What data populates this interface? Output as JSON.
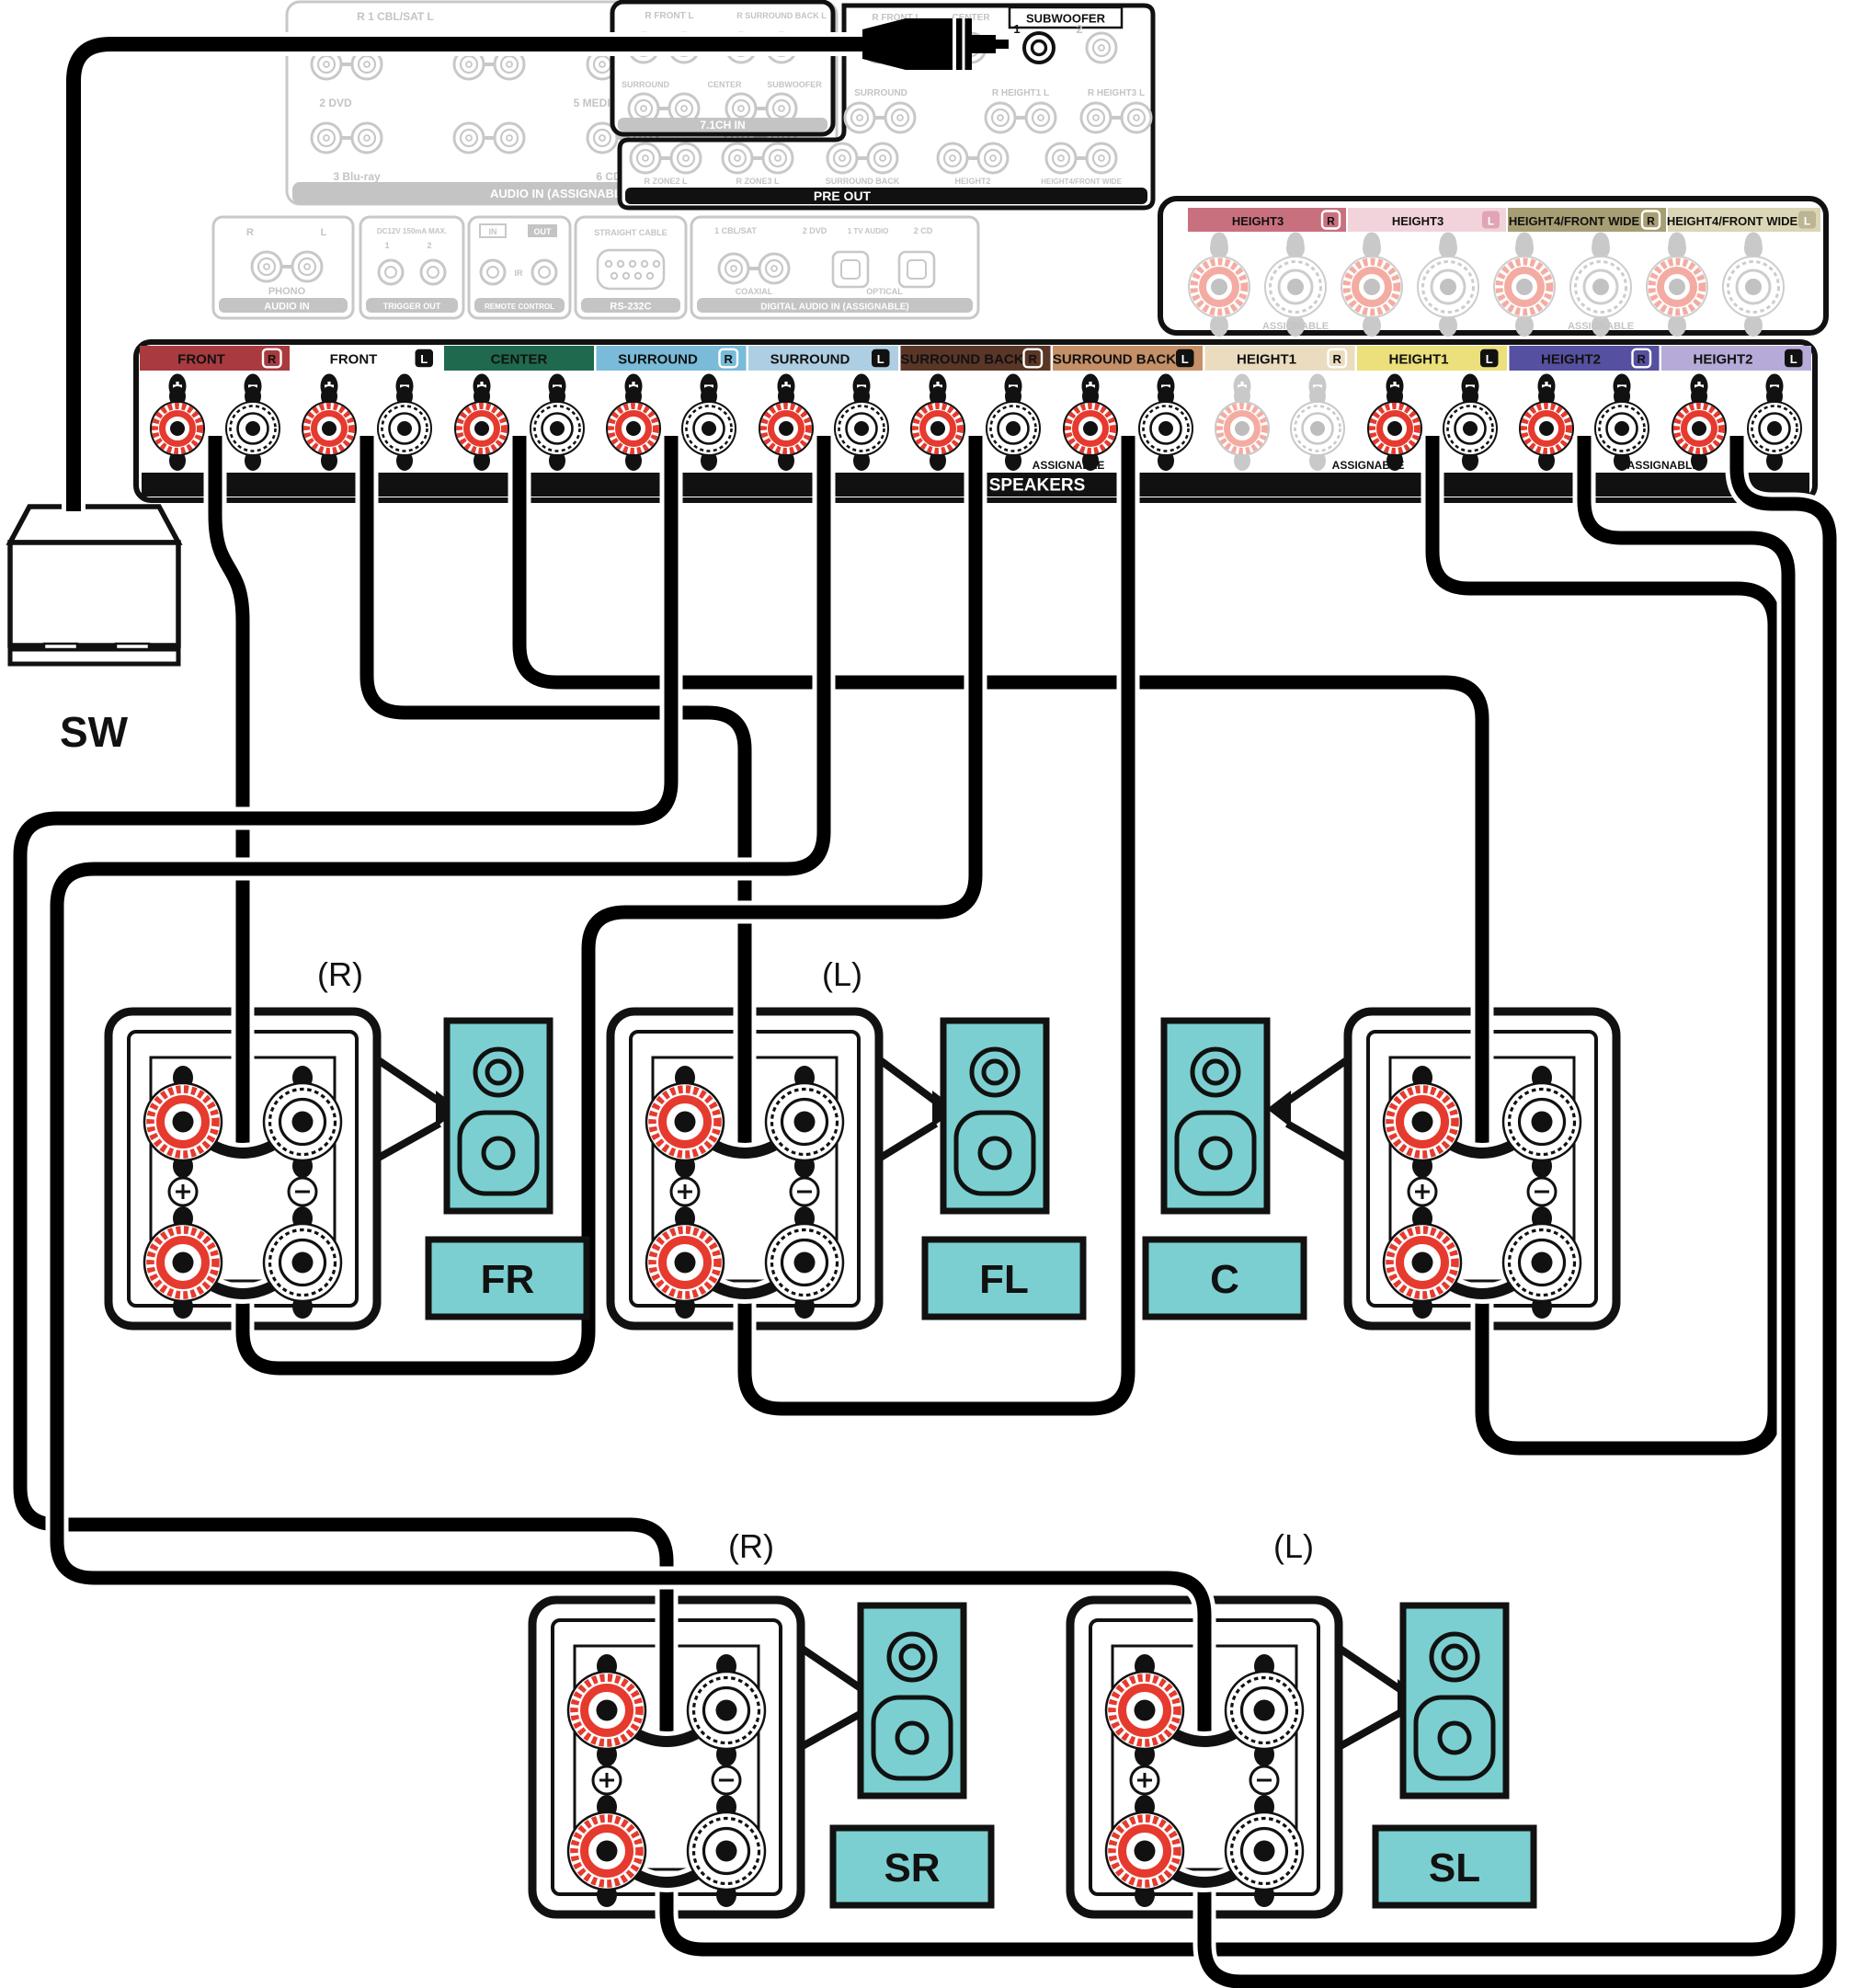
{
  "rear_panel": {
    "audio_panel": {
      "groups": [
        "R 1 CBL/SAT L",
        "R 4 GAME L"
      ],
      "mid": [
        "2 DVD",
        "5 MEDIA",
        "PLAYER"
      ],
      "low": [
        "3 Blu-ray",
        "6 CD"
      ],
      "bar": "AUDIO  IN  (ASSIGNABLE)"
    },
    "ch71_panel": {
      "groups": [
        "R FRONT L",
        "R SURROUND BACK L"
      ],
      "mid": [
        "SURROUND",
        "CENTER",
        "SUBWOOFER"
      ],
      "bar": "7.1CH IN"
    },
    "preout_panel": {
      "front": "R FRONT L",
      "center": "CENTER",
      "subwoofer": "SUBWOOFER",
      "jack1": "1",
      "jack2": "2",
      "mid": [
        "SURROUND",
        "R HEIGHT1 L",
        "R HEIGHT3 L"
      ],
      "low": [
        "R ZONE2 L",
        "R ZONE3 L",
        "SURROUND BACK",
        "HEIGHT2",
        "HEIGHT4/FRONT WIDE"
      ],
      "bar": "PRE OUT"
    },
    "phono_panel": {
      "r": "R",
      "l": "L",
      "name": "PHONO",
      "bar": "AUDIO  IN"
    },
    "trigger_panel": {
      "top": "DC12V 150mA MAX.",
      "n1": "1",
      "n2": "2",
      "bar": "TRIGGER OUT"
    },
    "remote_panel": {
      "in": "IN",
      "out": "OUT",
      "ir": "IR",
      "bar": "REMOTE CONTROL"
    },
    "rs232_panel": {
      "top": "STRAIGHT CABLE",
      "bar": "RS-232C"
    },
    "digital_panel": {
      "tops": [
        "1 CBL/SAT",
        "2 DVD",
        "1 TV AUDIO",
        "2 CD"
      ],
      "coaxial": "COAXIAL",
      "optical": "OPTICAL",
      "bar": "DIGITAL AUDIO  IN  (ASSIGNABLE)"
    },
    "height34_panel": {
      "headers": [
        {
          "text": "HEIGHT3",
          "ch": "R",
          "bg": "#C9707F",
          "fg": "#FFFFFF"
        },
        {
          "text": "HEIGHT3",
          "ch": "L",
          "bg": "#F2D3DB",
          "fg": "#DFA5B5"
        },
        {
          "text": "HEIGHT4/FRONT WIDE",
          "ch": "R",
          "bg": "#A89E73",
          "fg": "#FFFFFF"
        },
        {
          "text": "HEIGHT4/FRONT WIDE",
          "ch": "L",
          "bg": "#DAD6B6",
          "fg": "#BBB593"
        }
      ],
      "assignable": "ASSIGNABLE"
    },
    "terminals": {
      "channels": [
        {
          "text": "FRONT",
          "ch": "R",
          "bg": "#A93B40",
          "fg": "#FFFFFF"
        },
        {
          "text": "FRONT",
          "ch": "L",
          "bg": "#FFFFFF",
          "fg": "#111111"
        },
        {
          "text": "CENTER",
          "ch": "",
          "bg": "#1F6A4E",
          "fg": "#FFFFFF"
        },
        {
          "text": "SURROUND",
          "ch": "R",
          "bg": "#79BBD8",
          "fg": "#FFFFFF"
        },
        {
          "text": "SURROUND",
          "ch": "L",
          "bg": "#AECFE3",
          "fg": "#111111"
        },
        {
          "text": "SURROUND BACK",
          "ch": "R",
          "bg": "#5A3627",
          "fg": "#FFFFFF"
        },
        {
          "text": "SURROUND BACK",
          "ch": "L",
          "bg": "#C59067",
          "fg": "#111111"
        },
        {
          "text": "HEIGHT1",
          "ch": "R",
          "bg": "#EBDCC0",
          "fg": "#FFFFFF"
        },
        {
          "text": "HEIGHT1",
          "ch": "L",
          "bg": "#EBE07B",
          "fg": "#111111"
        },
        {
          "text": "HEIGHT2",
          "ch": "R",
          "bg": "#55509F",
          "fg": "#FFFFFF"
        },
        {
          "text": "HEIGHT2",
          "ch": "L",
          "bg": "#B6ABD8",
          "fg": "#111111"
        }
      ],
      "assignable": "ASSIGNABLE",
      "bar": "SPEAKERS"
    }
  },
  "speakers": {
    "sw": "SW",
    "fr": {
      "side": "(R)",
      "label": "FR"
    },
    "fl": {
      "side": "(L)",
      "label": "FL"
    },
    "c": {
      "label": "C"
    },
    "sr": {
      "side": "(R)",
      "label": "SR"
    },
    "sl": {
      "side": "(L)",
      "label": "SL"
    }
  },
  "colors": {
    "speaker_teal": "#7CCFD0",
    "terminal_red": "#E63A2E",
    "terminal_red_faded": "#F4ACA2",
    "faded_gray": "#C4C4C4",
    "cable": "#000000"
  }
}
